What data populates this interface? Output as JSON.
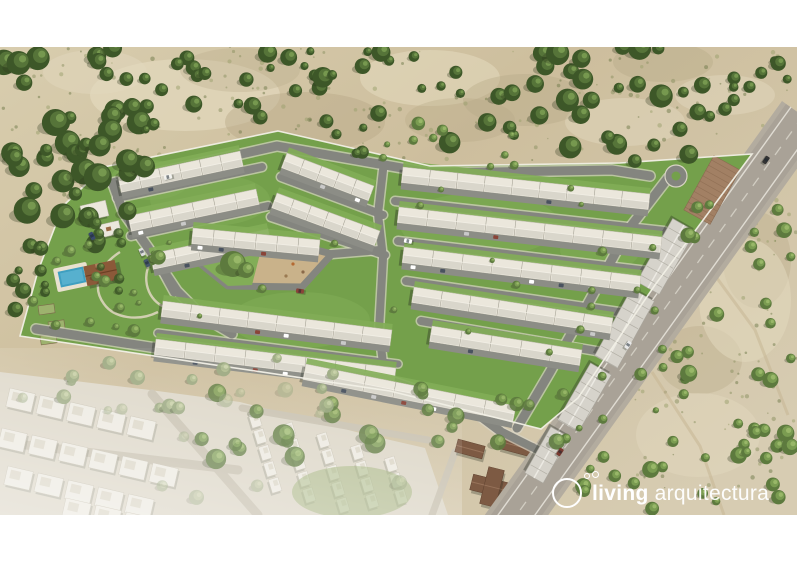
{
  "logo": {
    "brand_bold": "living",
    "brand_light": "arquitectura",
    "color": "#ffffff",
    "icon": "double-dot-circle-icon"
  },
  "scene": {
    "colors": {
      "sand1": "#d8cdae",
      "sand2": "#cdbe9d",
      "sand3": "#d7ccb2",
      "patch_light": "#e2d8bd",
      "patch_dark": "#b7a987",
      "grass": "#74a04b",
      "grass_light": "#82ad57",
      "road": "#84857f",
      "curb": "#d8d4c4",
      "highway": "#a9a297",
      "shoulder": "#b3ac9f",
      "lane": "#e6e3da",
      "lane_center": "#d9d5ca",
      "roof": "#ebe7dc",
      "roof_back": "#d3d0c5",
      "drive": "#8c8d86",
      "shed": "#d6d3cb",
      "shed_ridge": "#eceae3",
      "shed_seam": "#b2afa5",
      "pave": "#a28064",
      "pool_deck": "#e8e1cf",
      "pool": "#3f9fc0",
      "pool_light": "#63b8d4",
      "club": "#8b5939",
      "church": "#7d5a43",
      "nb_base": "#ddd7c8",
      "nb_road": "#c9c2b1",
      "nb_house": "#edeae1",
      "wall": "#f1efe5",
      "plaza_sand": "#c9b28a",
      "tree_pals": [
        [
          "#3d5728",
          "#567439",
          "#76984f"
        ],
        [
          "#5d7a3e",
          "#7a9c51",
          "#98b768"
        ],
        [
          "#97a67c",
          "#aebc8e",
          "#c6d0a4"
        ]
      ]
    },
    "sand_patches": [
      [
        185,
        95,
        95,
        36,
        "L",
        0.7
      ],
      [
        430,
        78,
        70,
        28,
        "L",
        0.6
      ],
      [
        625,
        122,
        60,
        24,
        "L",
        0.5
      ],
      [
        95,
        72,
        52,
        22,
        "L",
        0.5
      ],
      [
        725,
        95,
        50,
        20,
        "L",
        0.5
      ],
      [
        305,
        122,
        80,
        30,
        "D",
        0.45
      ],
      [
        525,
        100,
        62,
        26,
        "D",
        0.4
      ],
      [
        663,
        62,
        50,
        20,
        "D",
        0.4
      ],
      [
        757,
        260,
        34,
        48,
        "D",
        0.35
      ],
      [
        700,
        360,
        42,
        34,
        "D",
        0.35
      ],
      [
        745,
        300,
        46,
        62,
        "L",
        0.55
      ],
      [
        698,
        435,
        62,
        42,
        "L",
        0.5
      ],
      [
        460,
        120,
        55,
        22,
        "D",
        0.35
      ],
      [
        240,
        70,
        60,
        22,
        "D",
        0.3
      ]
    ],
    "scrub": [
      [
        0,
        47,
        797,
        120,
        160,
        31
      ],
      [
        630,
        160,
        167,
        330,
        110,
        32
      ],
      [
        60,
        150,
        260,
        100,
        50,
        33
      ]
    ],
    "tracks": [
      [
        [
          700,
          255
        ],
        [
          755,
          330
        ],
        [
          788,
          415
        ]
      ],
      [
        [
          652,
          372
        ],
        [
          700,
          446
        ],
        [
          724,
          515
        ]
      ]
    ],
    "neighborhood": {
      "zone": [
        [
          0,
          372
        ],
        [
          150,
          390
        ],
        [
          240,
          402
        ],
        [
          310,
          420
        ],
        [
          360,
          433
        ],
        [
          425,
          448
        ],
        [
          448,
          515
        ],
        [
          0,
          515
        ]
      ],
      "roads": [
        {
          "pts": [
            [
              0,
              442
            ],
            [
              238,
              470
            ]
          ],
          "w": 9
        },
        {
          "pts": [
            [
              152,
              394
            ],
            [
              258,
              515
            ]
          ],
          "w": 9
        },
        {
          "pts": [
            [
              242,
              408
            ],
            [
              428,
              440
            ]
          ],
          "w": 7
        },
        {
          "pts": [
            [
              432,
              515
            ],
            [
              455,
              452
            ]
          ],
          "w": 7
        }
      ],
      "blocks": [
        [
          10,
          388,
          13,
          5,
          26,
          19,
          5
        ],
        [
          2,
          428,
          13,
          6,
          26,
          19,
          5
        ],
        [
          8,
          466,
          13,
          5,
          26,
          19,
          5
        ],
        [
          66,
          498,
          13,
          4,
          26,
          19,
          5
        ],
        [
          258,
          412,
          73,
          5,
          14,
          10,
          3
        ],
        [
          292,
          422,
          73,
          5,
          14,
          10,
          3
        ],
        [
          326,
          432,
          73,
          5,
          14,
          10,
          3
        ],
        [
          360,
          444,
          73,
          4,
          14,
          10,
          3
        ],
        [
          394,
          456,
          73,
          3,
          14,
          10,
          3
        ]
      ],
      "green": [
        352,
        492,
        60,
        26
      ],
      "wash": [
        0,
        348,
        462,
        167
      ]
    },
    "church": [
      [
        492,
        487,
        42,
        16,
        14
      ],
      [
        492,
        487,
        16,
        38,
        14
      ],
      [
        517,
        446,
        34,
        14,
        15
      ],
      [
        470,
        449,
        28,
        13,
        15
      ]
    ],
    "highway": {
      "shoulder": [
        [
          782,
          101
        ],
        [
          824,
          131
        ],
        [
          521,
          553
        ],
        [
          479,
          523
        ]
      ],
      "road": [
        [
          786,
          104
        ],
        [
          820,
          128
        ],
        [
          517,
          550
        ],
        [
          483,
          526
        ]
      ],
      "lines": [
        [
          [
            791,
            107
          ],
          [
            488,
            529
          ]
        ],
        [
          [
            815,
            125
          ],
          [
            512,
            547
          ]
        ]
      ],
      "center": [
        [
          803,
          116
        ],
        [
          500,
          538
        ]
      ]
    },
    "parcel": {
      "outline": [
        [
          278,
          131
        ],
        [
          430,
          166
        ],
        [
          620,
          163
        ],
        [
          752,
          154
        ],
        [
          655,
          285
        ],
        [
          578,
          398
        ],
        [
          541,
          429
        ],
        [
          390,
          391
        ],
        [
          20,
          336
        ],
        [
          38,
          271
        ],
        [
          63,
          206
        ],
        [
          104,
          167
        ]
      ],
      "patches": [
        [
          210,
          200,
          60,
          26
        ],
        [
          480,
          225,
          80,
          32
        ],
        [
          300,
          320,
          70,
          28
        ],
        [
          600,
          250,
          40,
          22
        ],
        [
          150,
          180,
          40,
          20
        ]
      ]
    },
    "park": {
      "paths": [
        "M120,252 C98,266 92,288 104,304 C114,318 138,322 158,312",
        "M152,258 C140,280 148,300 166,308"
      ],
      "beds": [
        [
          38,
          306
        ],
        [
          48,
          322
        ],
        [
          40,
          336
        ]
      ],
      "pool": {
        "cx": 72,
        "cy": 277,
        "ang": -12
      },
      "club": {
        "cx": 101,
        "cy": 273,
        "ang": -12
      }
    },
    "roads": [
      {
        "pts": [
          [
            112,
            183
          ],
          [
            277,
            146
          ],
          [
            430,
            173
          ],
          [
            612,
            170
          ],
          [
            650,
            176
          ]
        ],
        "w": 9
      },
      {
        "pts": [
          [
            113,
            184
          ],
          [
            123,
            212
          ],
          [
            149,
            249
          ],
          [
            177,
            291
          ],
          [
            203,
            317
          ],
          [
            232,
            334
          ]
        ],
        "w": 9
      },
      {
        "pts": [
          [
            36,
            329
          ],
          [
            150,
            347
          ],
          [
            390,
            381
          ],
          [
            468,
            407
          ],
          [
            500,
            431
          ]
        ],
        "w": 9
      },
      {
        "pts": [
          [
            500,
            431
          ],
          [
            542,
            452
          ]
        ],
        "w": 8
      },
      {
        "pts": [
          [
            668,
            178
          ],
          [
            628,
            230
          ],
          [
            590,
            300
          ],
          [
            550,
            372
          ],
          [
            517,
            428
          ]
        ],
        "w": 9
      },
      {
        "pts": [
          [
            117,
            198
          ],
          [
            262,
            167
          ]
        ],
        "w": 8
      },
      {
        "pts": [
          [
            131,
            236
          ],
          [
            268,
            206
          ]
        ],
        "w": 8
      },
      {
        "pts": [
          [
            281,
            177
          ],
          [
            383,
            215
          ]
        ],
        "w": 8
      },
      {
        "pts": [
          [
            271,
            217
          ],
          [
            385,
            255
          ]
        ],
        "w": 8
      },
      {
        "pts": [
          [
            383,
            170
          ],
          [
            378,
            214
          ],
          [
            383,
            258
          ],
          [
            379,
            330
          ],
          [
            384,
            372
          ]
        ],
        "w": 8
      },
      {
        "pts": [
          [
            395,
            201
          ],
          [
            664,
            231
          ]
        ],
        "w": 8
      },
      {
        "pts": [
          [
            398,
            241
          ],
          [
            648,
            271
          ]
        ],
        "w": 8
      },
      {
        "pts": [
          [
            406,
            281
          ],
          [
            626,
            313
          ]
        ],
        "w": 8
      },
      {
        "pts": [
          [
            421,
            321
          ],
          [
            602,
            352
          ]
        ],
        "w": 8
      },
      {
        "pts": [
          [
            332,
            254
          ],
          [
            380,
            250
          ]
        ],
        "w": 8
      },
      {
        "pts": [
          [
            150,
            250
          ],
          [
            163,
            273
          ],
          [
            174,
            293
          ]
        ],
        "w": 7
      },
      {
        "pts": [
          [
            158,
            333
          ],
          [
            398,
            364
          ]
        ],
        "w": 7
      }
    ],
    "culdesac": {
      "x": 676,
      "y": 176,
      "r": 11
    },
    "plaza": {
      "outline": [
        [
          197,
          261
        ],
        [
          285,
          242
        ],
        [
          332,
          254
        ],
        [
          302,
          287
        ],
        [
          228,
          286
        ]
      ],
      "green": [
        [
          197,
          261
        ],
        [
          262,
          246
        ],
        [
          252,
          285
        ],
        [
          228,
          286
        ]
      ],
      "tree": [
        233,
        264
      ],
      "play_dots": [
        [
          293,
          264,
          "#b46a32"
        ],
        [
          303,
          272,
          "#8a6a4a"
        ],
        [
          286,
          276,
          "#9a7a52"
        ]
      ]
    },
    "commercial": {
      "pave": [
        [
          712,
          190,
          62,
          30,
          119
        ]
      ],
      "sheds": [
        [
          684,
          225,
          648,
          288,
          26
        ],
        [
          643,
          295,
          606,
          362,
          26
        ],
        [
          601,
          369,
          568,
          426,
          24
        ],
        [
          560,
          432,
          534,
          478,
          21
        ]
      ]
    },
    "house_rows": [
      [
        118,
        177,
        240,
        151,
        6
      ],
      [
        128,
        216,
        256,
        189,
        6
      ],
      [
        150,
        254,
        268,
        229,
        5
      ],
      [
        193,
        228,
        320,
        240,
        6
      ],
      [
        287,
        153,
        374,
        186,
        5
      ],
      [
        277,
        193,
        380,
        231,
        6
      ],
      [
        403,
        167,
        650,
        194,
        9
      ],
      [
        399,
        207,
        662,
        237,
        9
      ],
      [
        404,
        247,
        641,
        276,
        8
      ],
      [
        414,
        287,
        613,
        318,
        7
      ],
      [
        432,
        326,
        582,
        350,
        5
      ],
      [
        163,
        301,
        392,
        330,
        8
      ],
      [
        156,
        339,
        396,
        368,
        8
      ],
      [
        306,
        364,
        516,
        406,
        7
      ]
    ],
    "service_buildings": [
      [
        80,
        206,
        26,
        16,
        -13
      ],
      [
        99,
        225,
        20,
        13,
        -13
      ]
    ],
    "tree_regions": [
      [
        0,
        47,
        150,
        200,
        46,
        6,
        14,
        0,
        1,
        11
      ],
      [
        135,
        50,
        180,
        105,
        20,
        4,
        10,
        0,
        1,
        12
      ],
      [
        300,
        47,
        215,
        115,
        22,
        4,
        11,
        0,
        1,
        13
      ],
      [
        495,
        47,
        215,
        125,
        32,
        5,
        12,
        0,
        1,
        14
      ],
      [
        380,
        118,
        140,
        55,
        8,
        3,
        7,
        1,
        1,
        15
      ],
      [
        0,
        228,
        48,
        125,
        10,
        4,
        9,
        0,
        1,
        16
      ],
      [
        88,
        215,
        45,
        95,
        7,
        3,
        7,
        0,
        0.9,
        17
      ],
      [
        718,
        47,
        79,
        66,
        9,
        4,
        8,
        0,
        1,
        18
      ],
      [
        688,
        195,
        109,
        130,
        13,
        4,
        8,
        1,
        1,
        19
      ],
      [
        640,
        330,
        157,
        115,
        16,
        4,
        9,
        1,
        1,
        20
      ],
      [
        560,
        428,
        237,
        87,
        22,
        4,
        9,
        1,
        1,
        21
      ],
      [
        420,
        385,
        175,
        85,
        12,
        5,
        9,
        1,
        0.9,
        22
      ],
      [
        200,
        388,
        185,
        72,
        13,
        6,
        11,
        1,
        0.85,
        23
      ],
      [
        40,
        350,
        360,
        60,
        14,
        4,
        8,
        2,
        0.9,
        24
      ],
      [
        0,
        378,
        430,
        130,
        12,
        4,
        8,
        2,
        0.5,
        25
      ],
      [
        115,
        150,
        545,
        215,
        22,
        2.5,
        4.5,
        1,
        1,
        26
      ],
      [
        32,
        242,
        140,
        100,
        12,
        4,
        8,
        1,
        1,
        27
      ],
      [
        555,
        235,
        110,
        200,
        8,
        3,
        5,
        1,
        1,
        28
      ]
    ],
    "cars": [
      [
        168,
        177,
        -13,
        "#f2f2ee"
      ],
      [
        92,
        236,
        62,
        "#3a4a6b"
      ],
      [
        408,
        241,
        11,
        "#ffffff"
      ],
      [
        142,
        252,
        65,
        "#dddddd"
      ],
      [
        147,
        263,
        65,
        "#45566b"
      ],
      [
        766,
        160,
        124,
        "#333333"
      ],
      [
        628,
        345,
        124,
        "#e8e8e8"
      ],
      [
        560,
        452,
        124,
        "#7a3a30"
      ],
      [
        300,
        291,
        8,
        "#8a4438"
      ]
    ]
  }
}
